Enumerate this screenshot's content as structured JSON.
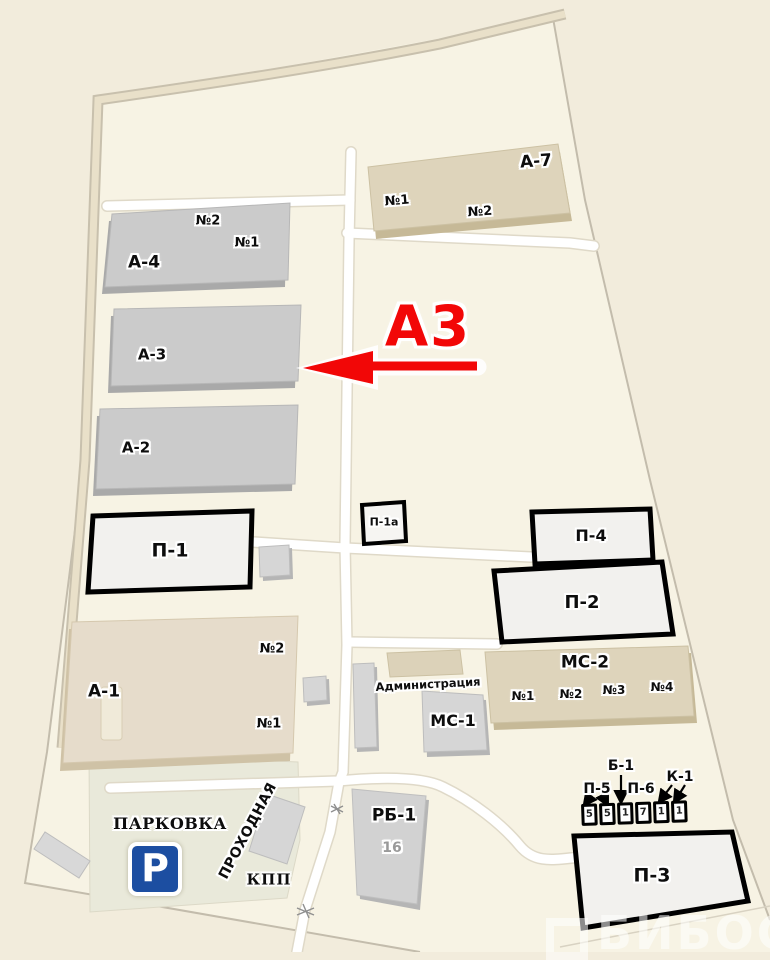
{
  "callout": {
    "label": "А3",
    "color": "#f20707"
  },
  "buildings": {
    "a1": {
      "label": "А-1",
      "sections": [
        "№1",
        "№2"
      ]
    },
    "a2": {
      "label": "А-2"
    },
    "a3": {
      "label": "А-3"
    },
    "a4": {
      "label": "А-4",
      "sections": [
        "№1",
        "№2"
      ]
    },
    "a7": {
      "label": "А-7",
      "sections": [
        "№1",
        "№2"
      ]
    },
    "p1": {
      "label": "П-1"
    },
    "p1a": {
      "label": "П-1а"
    },
    "p2": {
      "label": "П-2"
    },
    "p3": {
      "label": "П-3"
    },
    "p4": {
      "label": "П-4"
    },
    "ms1": {
      "label": "МС-1"
    },
    "ms2": {
      "label": "МС-2",
      "sections": [
        "№1",
        "№2",
        "№3",
        "№4"
      ]
    },
    "rb1": {
      "label": "РБ-1",
      "number": "16"
    },
    "admin": {
      "label": "Администрация"
    }
  },
  "areas": {
    "parking": "ПАРКОВКА",
    "parking_sign": "P",
    "checkpoint": "ПРОХОДНАЯ",
    "kpp": "КПП"
  },
  "legend_row": {
    "p5": "П-5",
    "b1": "Б-1",
    "p6": "П-6",
    "k1": "К-1",
    "boxes": [
      "5",
      "5",
      "1",
      "7",
      "1",
      "1"
    ]
  },
  "watermark": {
    "text": "БИБОСС"
  },
  "colors": {
    "red_accent": "#f20707",
    "background": "#f2ecdc",
    "site_fill": "#f7f3e4",
    "gray_building": "#cbcbcb",
    "beige_building": "#ded4bb",
    "white_building": "#f2f1ee",
    "parking_area": "#e9e9da",
    "road_white": "#ffffff",
    "parking_sign_blue": "#1c4ea1"
  }
}
